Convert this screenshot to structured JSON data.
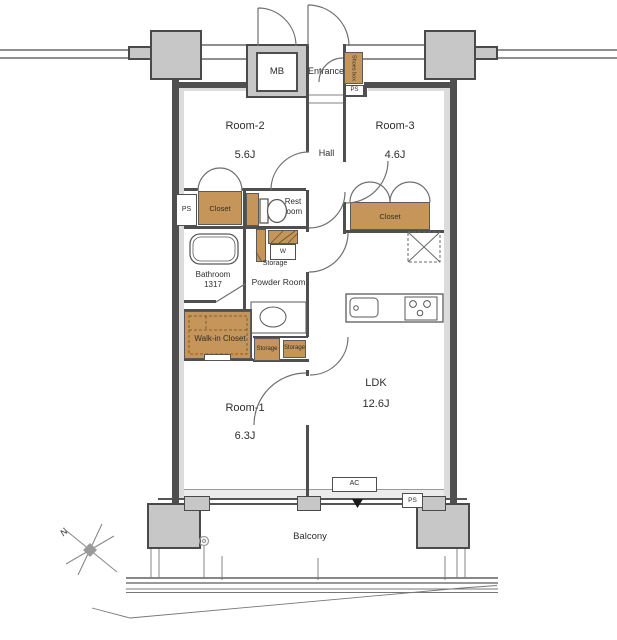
{
  "title": "Apartment floor plan 2LDK",
  "colors": {
    "closet_fill": "#c6955a",
    "pillar_fill": "#c7c7c7",
    "wall": "#4f4f4f",
    "line_gray": "#8f8f8f",
    "text": "#2e2e2e"
  },
  "rooms": {
    "room2": {
      "name": "Room-2",
      "size": "5.6J"
    },
    "room3": {
      "name": "Room-3",
      "size": "4.6J"
    },
    "room1": {
      "name": "Room-1",
      "size": "6.3J"
    },
    "ldk": {
      "name": "LDK",
      "size": "12.6J"
    },
    "hall": {
      "name": "Hall"
    },
    "entrance": {
      "name": "Entrance"
    },
    "bathroom": {
      "name": "Bathroom",
      "size": "1317"
    },
    "powder_room": {
      "name": "Powder Room"
    },
    "rest_room": {
      "name": "Rest room"
    },
    "walk_in_closet": {
      "name": "Walk-in Closet"
    },
    "balcony": {
      "name": "Balcony"
    }
  },
  "labels": {
    "mb": "MB",
    "shoes_box": "Shoes box",
    "ps": "PS",
    "closet": "Closet",
    "storage": "Storage",
    "washer": "W",
    "ac": "AC",
    "north": "N"
  }
}
